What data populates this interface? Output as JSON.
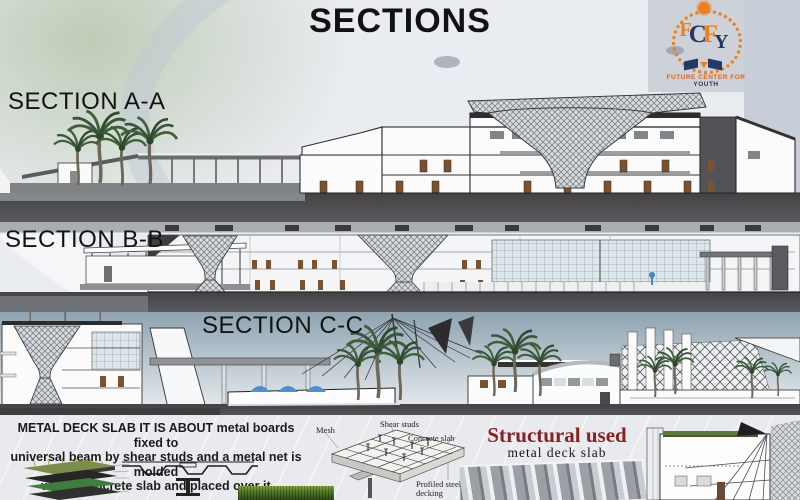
{
  "page": {
    "title": "SECTIONS"
  },
  "logo": {
    "letters": [
      "F",
      "C",
      "F",
      "Y"
    ],
    "caption_main": "FUTURE CENTER FOR",
    "caption_accent": "YOUTH",
    "orange": "#ee7f1d",
    "navy": "#223a66"
  },
  "sections": {
    "aa": "SECTION A-A",
    "bb": "SECTION B-B",
    "cc": "SECTION C-C"
  },
  "note": {
    "line1": "METAL DECK SLAB IT IS ABOUT metal boards fixed to",
    "line2": "universal beam by shear studs and a metal net is molded",
    "line3": "with a concrete slab and placed over it"
  },
  "deck_diagram": {
    "mesh": "Mesh",
    "shear_studs": "Shear studs",
    "concrete_slab": "Concrete slab",
    "profiled_decking": "Profiled steel decking"
  },
  "structural": {
    "heading": "Structural used",
    "subheading": "metal deck slab",
    "heading_color": "#8b2020"
  }
}
